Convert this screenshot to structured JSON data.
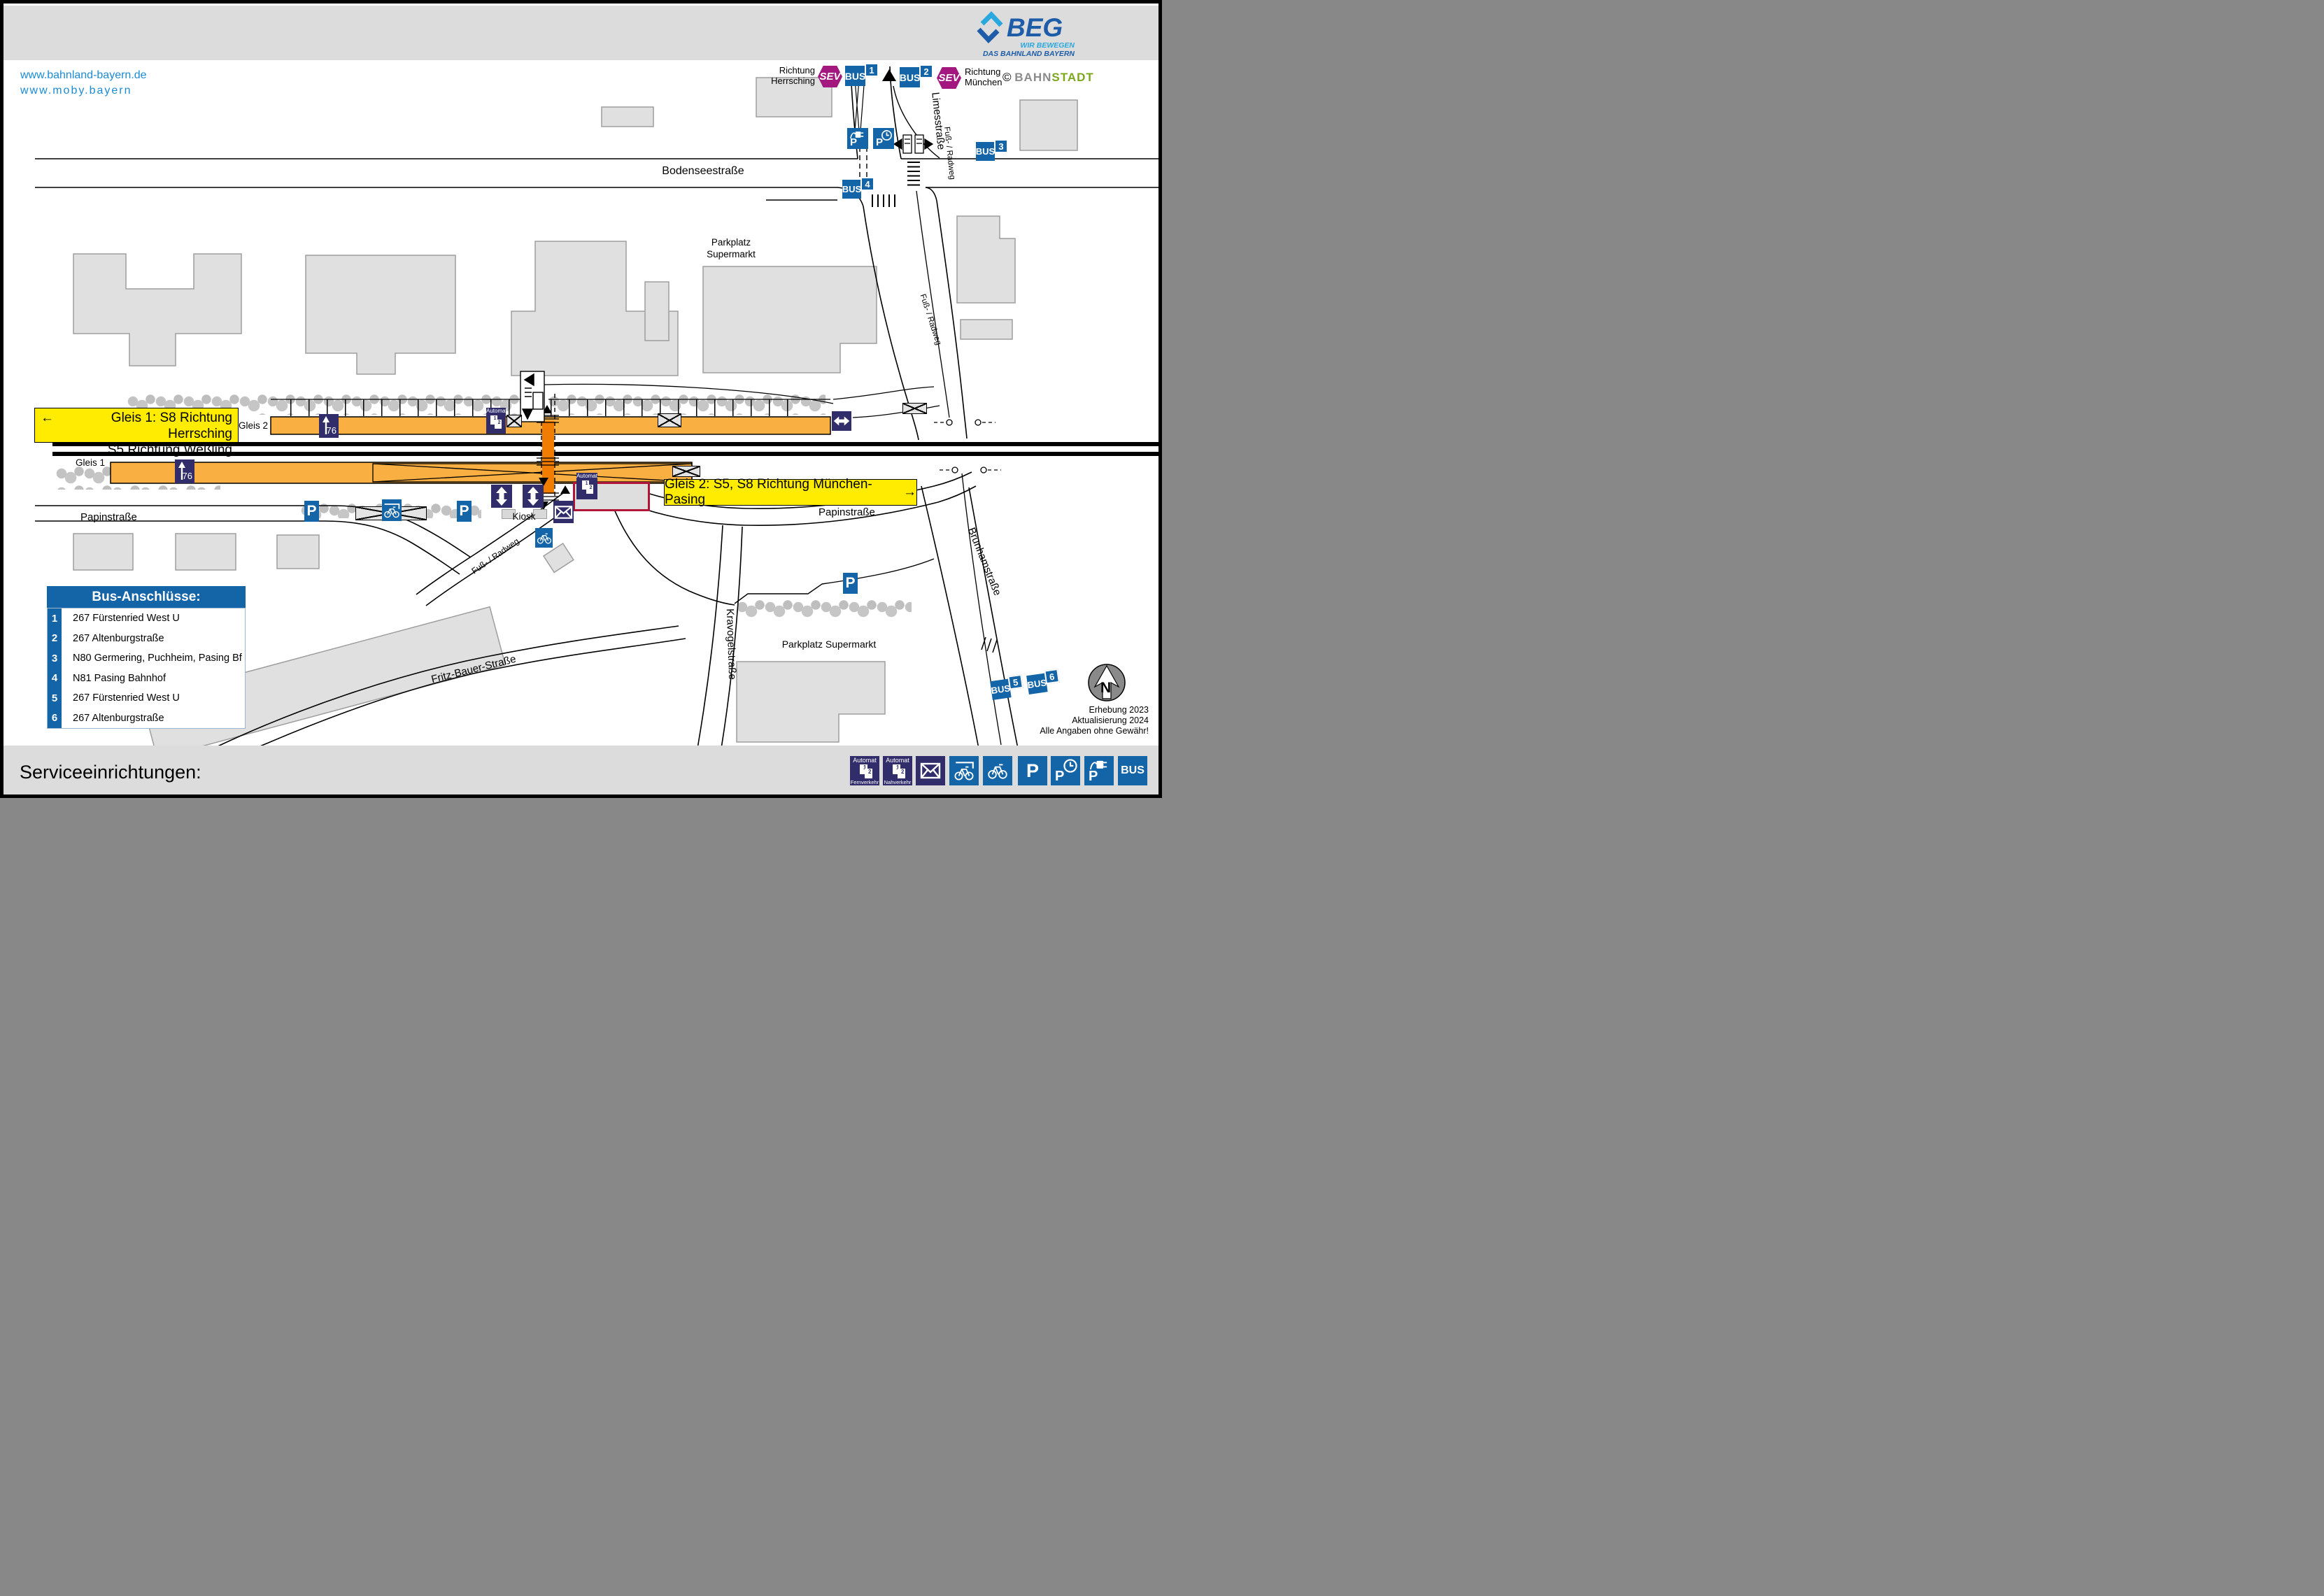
{
  "page": {
    "title": "München-Neuaubing",
    "url1": "www.bahnland-bayern.de",
    "url2": "www.moby.bayern"
  },
  "logo": {
    "beg": "BEG",
    "tagline1": "WIR BEWEGEN",
    "tagline2": "DAS BAHNLAND BAYERN",
    "credit_symbol": "©",
    "credit_bahn": "BAHN",
    "credit_stadt": "STADT"
  },
  "directions": {
    "herrsching1": "Richtung",
    "herrsching2": "Herrsching",
    "muenchen1": "Richtung",
    "muenchen2": "München"
  },
  "badges": {
    "sev": "SEV",
    "bus": "BUS",
    "p": "P",
    "n1": "1",
    "n2": "2",
    "n3": "3",
    "n4": "4",
    "n5": "5",
    "n6": "6"
  },
  "streets": {
    "bodenseestrasse": "Bodenseestraße",
    "limesstrasse": "Limesstraße",
    "brunhamstrasse": "Brunhamstraße",
    "papinstrasse": "Papinstraße",
    "kravogelstrasse": "Kravogelstraße",
    "fritz_bauer_strasse": "Fritz-Bauer-Straße",
    "fuss_radweg": "Fuß- / Radweg"
  },
  "map_labels": {
    "gleis1": "Gleis 1",
    "gleis2": "Gleis 2",
    "kiosk": "Kiosk",
    "parkplatz_top1": "Parkplatz",
    "parkplatz_top2": "Supermarkt",
    "parkplatz_bottom": "Parkplatz Supermarkt",
    "platform_height": "76"
  },
  "signs": {
    "gleis1_line1": "Gleis 1: S8 Richtung Herrsching",
    "gleis1_line2": "S5 Richtung Weßling",
    "gleis2_line": "Gleis 2: S5, S8 Richtung München-Pasing",
    "arrow_left": "←",
    "arrow_right": "→"
  },
  "automat": {
    "label": "Automat",
    "fernverkehr": "Fernverkehr",
    "nahverkehr": "Nahverkehr",
    "n1": "1",
    "n2": "2"
  },
  "legend": {
    "title": "Bus-Anschlüsse:",
    "items": [
      {
        "num": "1",
        "label": "267 Fürstenried West U"
      },
      {
        "num": "2",
        "label": "267 Altenburgstraße"
      },
      {
        "num": "3",
        "label": "N80 Germering, Puchheim, Pasing Bf"
      },
      {
        "num": "4",
        "label": "N81 Pasing Bahnhof"
      },
      {
        "num": "5",
        "label": "267 Fürstenried West U"
      },
      {
        "num": "6",
        "label": "267 Altenburgstraße"
      }
    ]
  },
  "footer": {
    "title": "Serviceeinrichtungen:"
  },
  "meta": {
    "line1": "Erhebung 2023",
    "line2": "Aktualisierung 2024",
    "line3": "Alle Angaben ohne Gewähr!",
    "north": "N"
  },
  "colors": {
    "accent_blue": "#1464A8",
    "navy": "#312D6B",
    "sev_magenta": "#A3187E",
    "signal_yellow": "#FFEC00",
    "platform_orange": "#F9AF42",
    "crossing_orange": "#F07D00"
  }
}
